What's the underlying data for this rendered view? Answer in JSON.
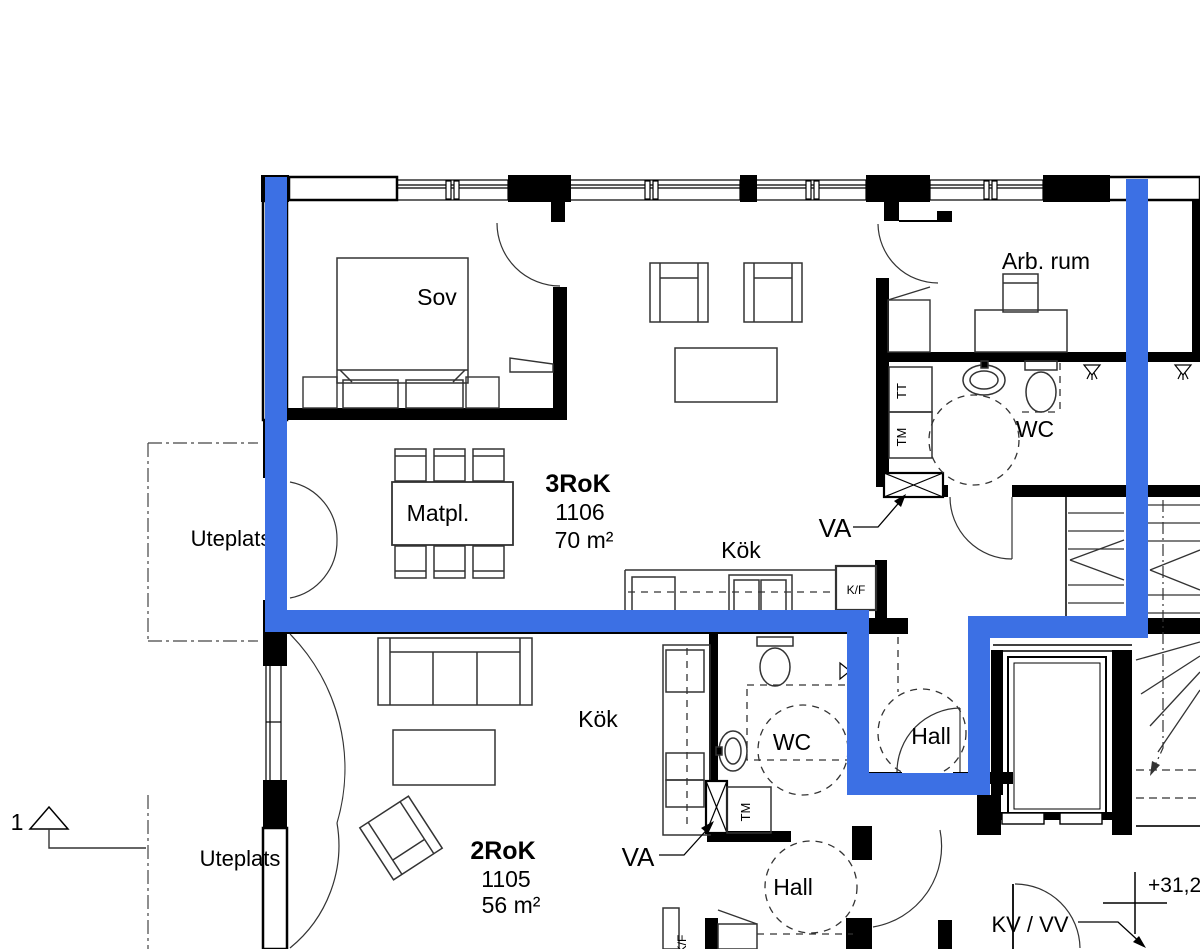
{
  "apartments": [
    {
      "type": "3RoK",
      "number": "1106",
      "area": "70 m²",
      "rooms": {
        "bedroom": "Sov",
        "dining": "Matpl.",
        "kitchen": "Kök",
        "wc": "WC",
        "hall": "Hall",
        "workroom": "Arb. rum"
      }
    },
    {
      "type": "2RoK",
      "number": "1105",
      "area": "56 m²",
      "rooms": {
        "kitchen": "Kök",
        "wc": "WC",
        "hall": "Hall"
      }
    }
  ],
  "outdoor": {
    "patio_upper": "Uteplats",
    "patio_lower": "Uteplats"
  },
  "annotations": {
    "va_upper": "VA",
    "va_lower": "VA",
    "kv_vv": "KV / VV",
    "level": "+31,2",
    "section_number": "1"
  },
  "appliances": {
    "tt": "TT",
    "tm_upper": "TM",
    "tm_lower": "TM",
    "kf_upper": "K/F",
    "kf_lower": "K/F"
  },
  "colors": {
    "highlight_blue": "#3c70e4",
    "line_black": "#000000",
    "background": "#ffffff"
  }
}
